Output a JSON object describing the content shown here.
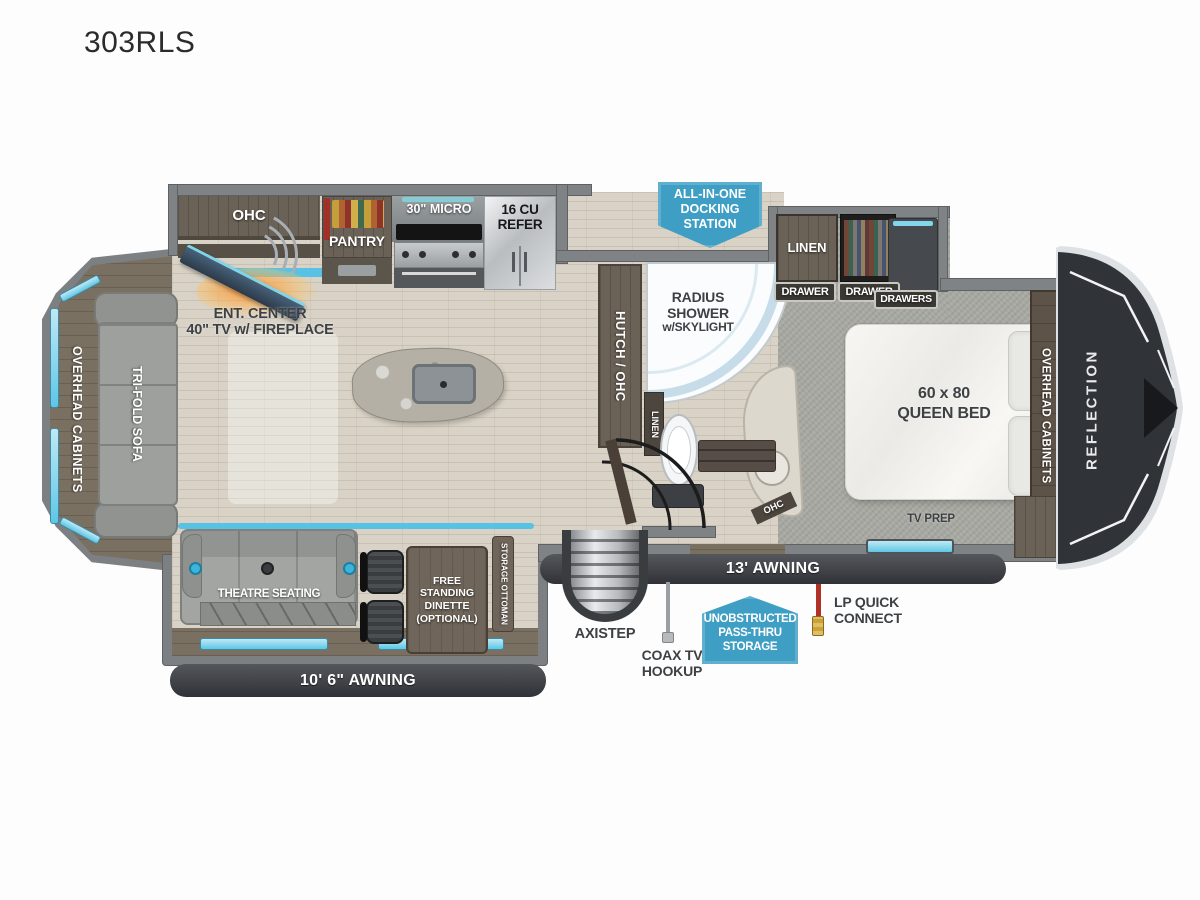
{
  "title": "303RLS",
  "colors": {
    "accent_cyan": "#5ec7e6",
    "badge_blue": "#3f9ec4",
    "awning_dark": "#34363a",
    "wall_gray": "#808386",
    "wood_dark": "#6b6257",
    "floor_wood": "#d9d3c7",
    "carpet_gray": "#a8a8a2",
    "label_dark": "#3e4144",
    "lp_red": "#b03227",
    "fireplace_orange": "#ff9632"
  },
  "kitchen": {
    "ohc": "OHC",
    "pantry": "PANTRY",
    "micro": "30\" MICRO",
    "refer_line1": "16 CU",
    "refer_line2": "REFER",
    "ent_line1": "ENT. CENTER",
    "ent_line2": "40\" TV w/ FIREPLACE"
  },
  "living": {
    "rear_cabinets": "OVERHEAD CABINETS",
    "sofa": "TRI-FOLD SOFA",
    "theatre": "THEATRE SEATING",
    "dinette_line1": "FREE",
    "dinette_line2": "STANDING",
    "dinette_line3": "DINETTE",
    "dinette_line4": "(OPTIONAL)",
    "ottoman": "STORAGE OTTOMAN"
  },
  "bath": {
    "shower_line1": "RADIUS",
    "shower_line2": "SHOWER",
    "shower_line3": "w/SKYLIGHT",
    "hutch": "HUTCH / OHC",
    "linen": "LINEN",
    "vanity_ohc": "OHC"
  },
  "bedroom": {
    "linen": "LINEN",
    "drawer_left": "DRAWER",
    "drawer_mid": "DRAWER",
    "drawers": "DRAWERS",
    "bed_line1": "60 x 80",
    "bed_line2": "QUEEN BED",
    "cabinets": "OVERHEAD CABINETS",
    "tv_prep": "TV PREP",
    "brand": "REFLECTION"
  },
  "exterior": {
    "docking_line1": "ALL-IN-ONE",
    "docking_line2": "DOCKING",
    "docking_line3": "STATION",
    "awning_main": "13' AWNING",
    "awning_rear": "10' 6\" AWNING",
    "axistep": "AXISTEP",
    "coax_line1": "COAX TV",
    "coax_line2": "HOOKUP",
    "passthru_line1": "UNOBSTRUCTED",
    "passthru_line2": "PASS-THRU",
    "passthru_line3": "STORAGE",
    "lp_line1": "LP QUICK",
    "lp_line2": "CONNECT"
  }
}
